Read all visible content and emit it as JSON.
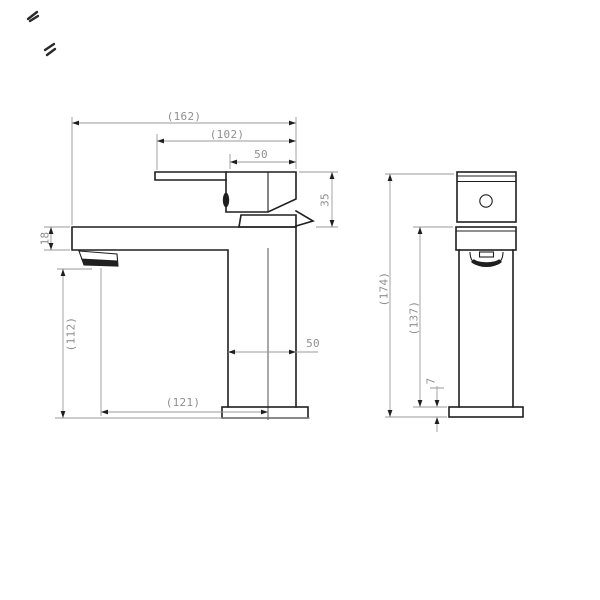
{
  "drawing": {
    "side_view": {
      "dim_162": "(162)",
      "dim_102": "(102)",
      "dim_50_top": "50",
      "dim_35": "35",
      "dim_18": "18",
      "dim_112": "(112)",
      "dim_50_body": "50",
      "dim_121": "(121)"
    },
    "front_view": {
      "dim_174": "(174)",
      "dim_137": "(137)",
      "dim_7": "7"
    }
  },
  "colors": {
    "object_line": "#1f1f1f",
    "dimension_line": "#9a9a9a",
    "dimension_text": "#8f8f8f",
    "axis_line": "#8c8c8c",
    "arrow": "#1f1f1f",
    "background": "#ffffff"
  }
}
